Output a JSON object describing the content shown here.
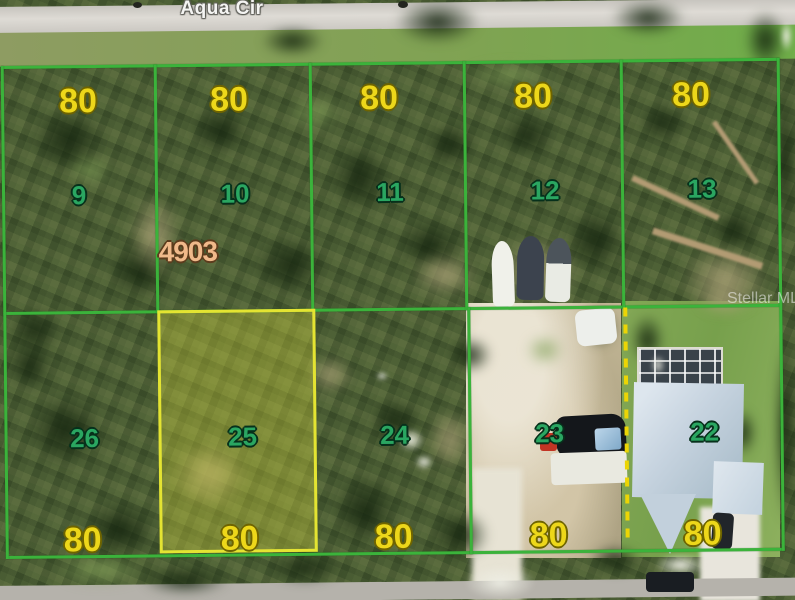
{
  "map": {
    "road_label": "Aqua Cir",
    "watermark": "Stellar MLS",
    "parcel_label": "4903",
    "highlighted_lot": "25",
    "top_row": [
      {
        "lot": "9",
        "dim": "80"
      },
      {
        "lot": "10",
        "dim": "80"
      },
      {
        "lot": "11",
        "dim": "80"
      },
      {
        "lot": "12",
        "dim": "80"
      },
      {
        "lot": "13",
        "dim": "80"
      }
    ],
    "bottom_row": [
      {
        "lot": "26",
        "dim": "80"
      },
      {
        "lot": "25",
        "dim": "80"
      },
      {
        "lot": "24",
        "dim": "80"
      },
      {
        "lot": "23",
        "dim": "80"
      },
      {
        "lot": "22",
        "dim": "80"
      }
    ],
    "colors": {
      "boundary_green": "#3bb33b",
      "highlight_yellow": "#e4e432",
      "dashed_boundary_yellow": "#ecd504",
      "dimension_text": "#edd71a",
      "lot_number_text": "#2aa661",
      "parcel_text": "#f0b98a"
    }
  }
}
